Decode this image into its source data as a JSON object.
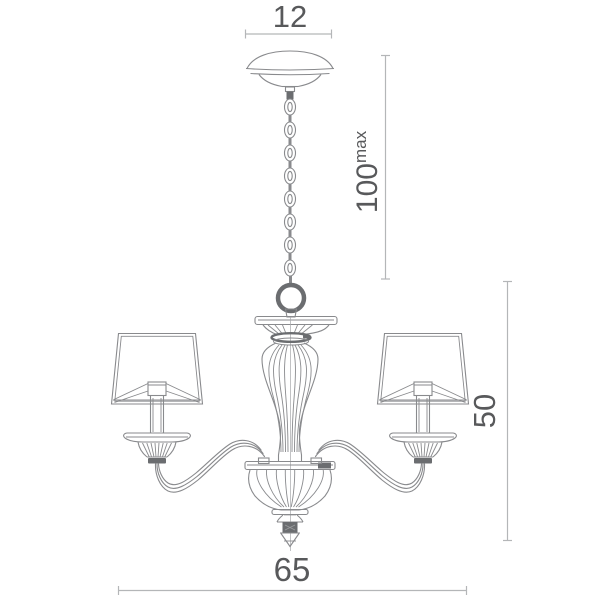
{
  "diagram": {
    "type": "chandelier dimensional line drawing",
    "labels": {
      "canopy_width": "12",
      "suspension_height": "100",
      "suspension_suffix": "max",
      "body_height": "50",
      "total_width": "65"
    },
    "colors": {
      "text": "#58595b",
      "line": "#898a8d",
      "dark_accent": "#6b6d70",
      "dimension_line": "#b4b6b8",
      "background": "#ffffff"
    }
  }
}
